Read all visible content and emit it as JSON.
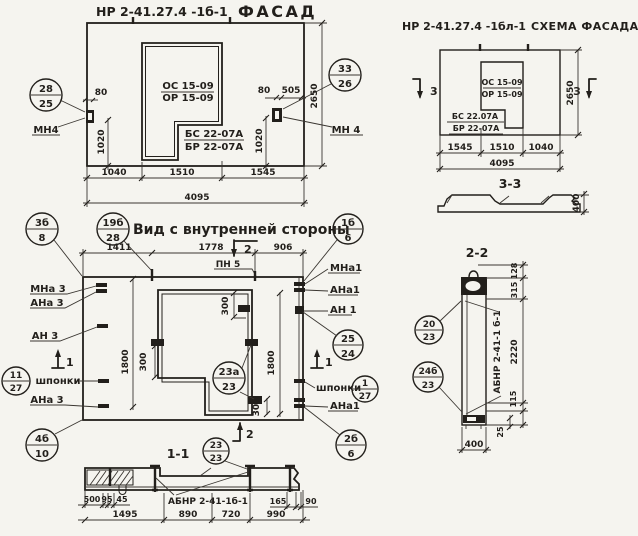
{
  "facade": {
    "title_code": "НР 2-41.27.4 -1б-1",
    "title_word": "ФАСАД",
    "os": "ОС 15-09",
    "or": "ОР 15-09",
    "bs": "БС 22-07А",
    "br": "БР 22-07А",
    "mn_left": "МН4",
    "mn_right": "МН 4",
    "co_left_top": "28",
    "co_left_bot": "25",
    "co_right_top": "33",
    "co_right_bot": "26",
    "d80l": "80",
    "d80r": "80",
    "d505": "505",
    "d1020l": "1020",
    "d1020r": "1020",
    "d2650": "2650",
    "dw1": "1040",
    "dw2": "1510",
    "dw3": "1545",
    "dtot": "4095"
  },
  "scheme": {
    "title_code": "НР 2-41.27.4 -1бл-1",
    "title_word": "СХЕМА ФАСАДА",
    "os": "ОС 15-09",
    "or": "ОР 15-09",
    "bs": "БС 22.07А",
    "br": "БР 22-07А",
    "sec3_left": "3",
    "sec3_right": "3",
    "dw1": "1545",
    "dw2": "1510",
    "dw3": "1040",
    "dtot": "4095",
    "d2650": "2650",
    "sec33_label": "3-3",
    "d400": "400"
  },
  "inner": {
    "title": "Вид с внутренней стороны",
    "co": {
      "c3b_top": "3б",
      "c3b_bot": "8",
      "c19b_top": "19б",
      "c19b_bot": "28",
      "c1b_top": "1б",
      "c1b_bot": "6",
      "c2524_top": "25",
      "c2524_bot": "24",
      "c127_top": "1",
      "c127_bot": "27",
      "c1127_top": "11",
      "c1127_bot": "27",
      "c4b_top": "4б",
      "c4b_bot": "10",
      "c23a_top": "23а",
      "c23a_bot": "23",
      "c2b_top": "2б",
      "c2b_bot": "6"
    },
    "lb": {
      "mna3": "МНа 3",
      "ana3": "АНа 3",
      "an3": "АН 3",
      "shp_l": "шпонки",
      "ana3b": "АНа 3",
      "mna1": "МНа1",
      "ana1": "АНа1",
      "an1": "АН 1",
      "shp_r": "шпонки",
      "ana1b": "АНа1",
      "pn5": "ПН 5"
    },
    "dm": {
      "a": "1411",
      "b": "1778",
      "c": "906",
      "l1800": "1800",
      "r1800": "1800",
      "t300": "300",
      "l300": "300",
      "b300": "300"
    },
    "sec2_top": "2",
    "sec2_bot": "2",
    "sec1_left": "1",
    "sec1_right": "1"
  },
  "sec11": {
    "label": "1-1",
    "abnr": "АБНР 2-41-1б-1",
    "co_top": "23",
    "co_bot": "23",
    "d": {
      "d500": "500",
      "d95": "95",
      "d45": "45",
      "d1495": "1495",
      "d890": "890",
      "d720": "720",
      "d990": "990",
      "d165": "165",
      "d90": "90"
    }
  },
  "sec22": {
    "label": "2-2",
    "abnr": "АБНР 2-41-1 б-1",
    "co1_top": "20",
    "co1_bot": "23",
    "co2_top": "24б",
    "co2_bot": "23",
    "d": {
      "d128": "128",
      "d315": "315",
      "d2220": "2220",
      "d115": "115",
      "d25": "25",
      "d400": "400"
    }
  }
}
